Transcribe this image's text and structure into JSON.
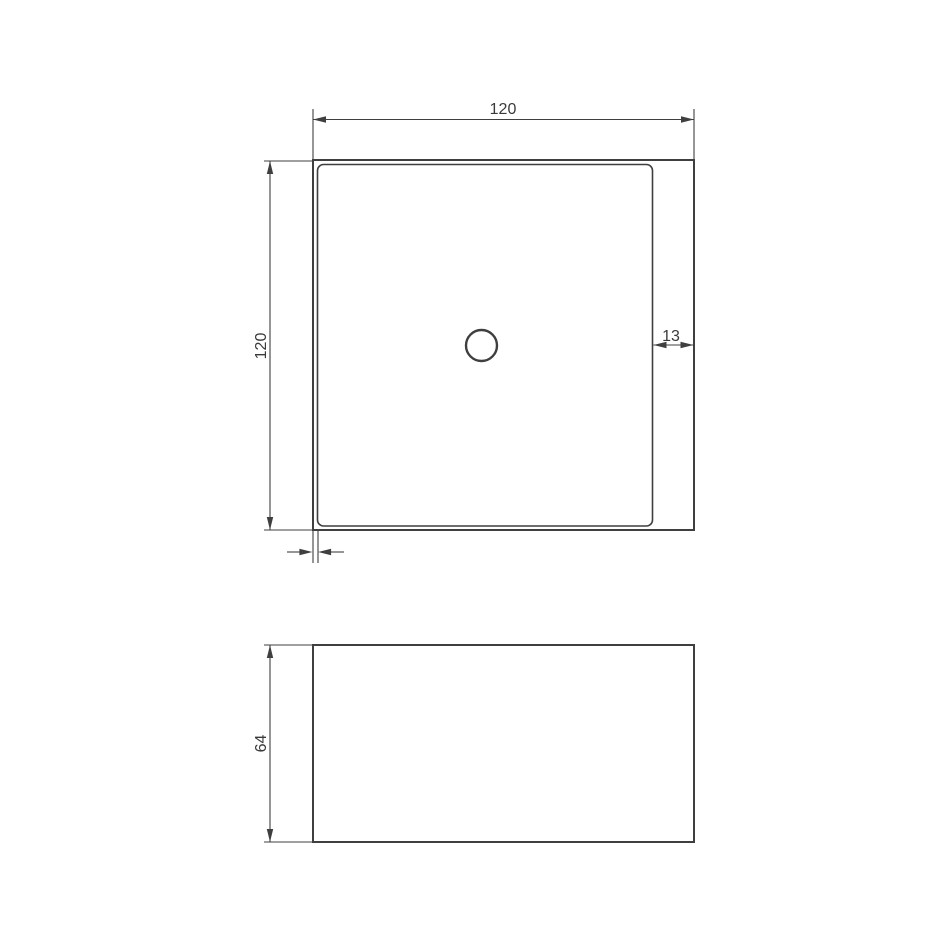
{
  "colors": {
    "background": "#ffffff",
    "line": "#3f3f3f",
    "text": "#3a3a3a"
  },
  "dimensions": {
    "top_view": {
      "width": "120",
      "height": "120",
      "right_inset": "13"
    },
    "front_view": {
      "height": "64"
    }
  }
}
